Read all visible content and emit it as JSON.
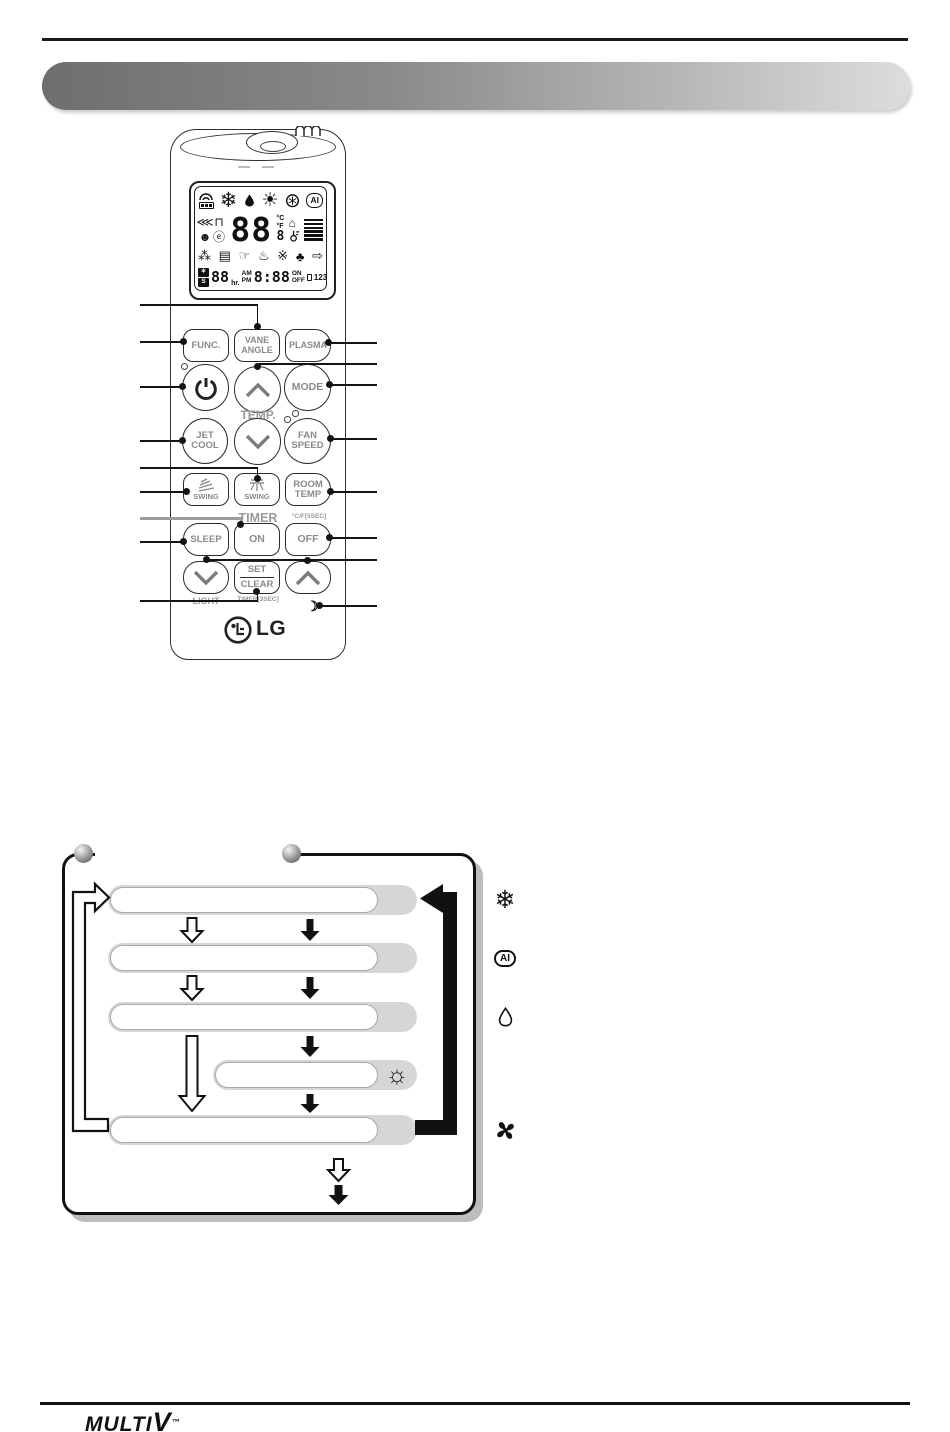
{
  "banner": {
    "title": ""
  },
  "remote": {
    "lcd": {
      "icons_row1": {
        "snow": "❄",
        "sun": "☀",
        "fan": "⊛",
        "ai": "AI"
      },
      "icons_row2": {
        "spray": "⋘",
        "vane": "⊓",
        "person": "☻",
        "plug": "ⓔ",
        "digits": "88",
        "deg_c": "°C",
        "deg_f": "°F",
        "sub_digit": "8",
        "house": "⌂"
      },
      "icons_row3": {
        "humid": "⁂",
        "door": "▤",
        "hand": "☞",
        "heat": "♨",
        "ion": "※",
        "tree": "♣",
        "arrow": "⇨"
      },
      "row4": {
        "auto": "✶",
        "sleep_s": "S",
        "digits": "88",
        "unit": "hr.",
        "am": "AM",
        "pm": "PM",
        "time": "8:88",
        "on": "ON",
        "off": "OFF",
        "nums": "123"
      }
    },
    "buttons": {
      "func": "FUNC.",
      "vane_angle": "VANE ANGLE",
      "plasma": "PLASMA",
      "mode": "MODE",
      "jet_cool": "JET COOL",
      "fan_speed": "FAN SPEED",
      "swing": "SWING",
      "room_temp": "ROOM TEMP",
      "sleep": "SLEEP",
      "on": "ON",
      "off": "OFF",
      "set": "SET",
      "clear": "CLEAR"
    },
    "labels": {
      "temp": "TEMP.",
      "timer": "TIMER",
      "cf5sec": "°C/F[5SEC]",
      "light": "LIGHT",
      "timer3sec": "TIMER[3SEC]",
      "crescent": "☾"
    },
    "logo": "LG"
  },
  "flowchart": {
    "modes": [
      {
        "name": "cooling-mode",
        "icon": "❄"
      },
      {
        "name": "ai-auto-mode",
        "icon": "AI"
      },
      {
        "name": "dehumidify-mode",
        "icon": "drop"
      },
      {
        "name": "heating-mode",
        "icon": "☼"
      },
      {
        "name": "fan-mode",
        "icon": "fan"
      }
    ]
  },
  "footer": {
    "brand_multi": "MULTI",
    "brand_v": "V",
    "tm": "™"
  },
  "colors": {
    "pill_gray": "#d6d6d6",
    "banner_dark": "#6e6e6e",
    "banner_light": "#dddddd"
  }
}
